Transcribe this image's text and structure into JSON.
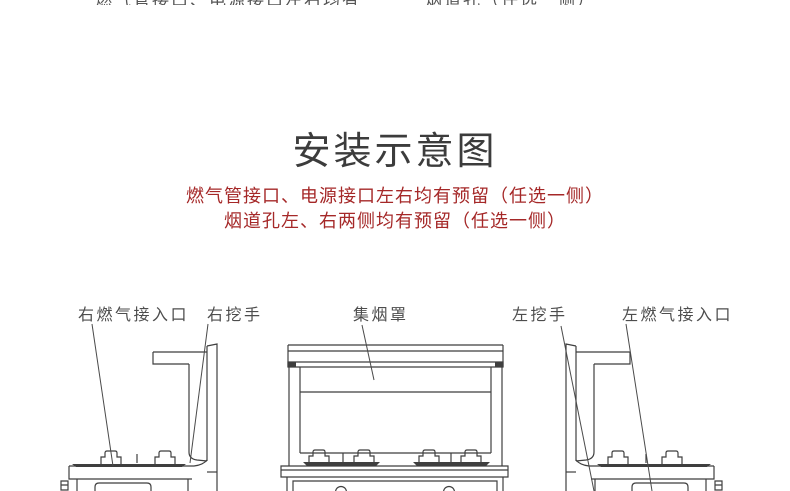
{
  "top_clipped": {
    "left": "燃气管接口、电源接口左右均有预留",
    "right": "烟道孔（任选一侧）"
  },
  "title": "安装示意图",
  "notes": {
    "line1": "燃气管接口、电源接口左右均有预留（任选一侧）",
    "line2": "烟道孔左、右两侧均有预留（任选一侧）",
    "color": "#a52828"
  },
  "diagram": {
    "type": "installation line drawing of integrated stove, three views",
    "stroke_color": "#3f3f3f",
    "labels": [
      {
        "id": "gas-right",
        "text": "右燃气接入口"
      },
      {
        "id": "handle-right",
        "text": "右挖手"
      },
      {
        "id": "hood",
        "text": "集烟罩"
      },
      {
        "id": "handle-left",
        "text": "左挖手"
      },
      {
        "id": "gas-left",
        "text": "左燃气接入口"
      }
    ]
  }
}
